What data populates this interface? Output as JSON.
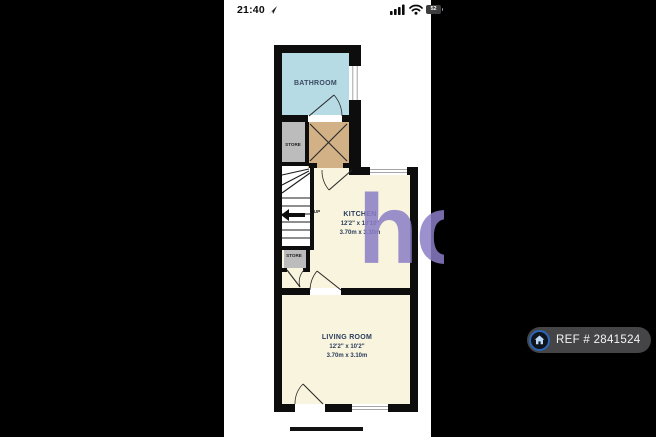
{
  "status_bar": {
    "time": "21:40",
    "battery_percent": "52"
  },
  "floorplan": {
    "bathroom": {
      "label": "BATHROOM"
    },
    "store_upper": {
      "label": "STORE"
    },
    "store_lower": {
      "label": "STORE"
    },
    "stairs": {
      "direction_label": "UP"
    },
    "kitchen": {
      "label": "KITCHEN",
      "imperial": "12'2\" x 10'10\"",
      "metric": "3.70m x 3.30m"
    },
    "living_room": {
      "label": "LIVING ROOM",
      "imperial": "12'2\" x 10'2\"",
      "metric": "3.70m x 3.10m"
    },
    "colors": {
      "bathroom": "#b7dbe4",
      "hallway": "#d3b186",
      "store": "#bcbcbc",
      "rooms": "#f8f4dd",
      "walls": "#0d0d0d"
    }
  },
  "watermark": {
    "text": "ho",
    "color": "#8b7ec6"
  },
  "ref_badge": {
    "label": "REF # 2841524"
  }
}
